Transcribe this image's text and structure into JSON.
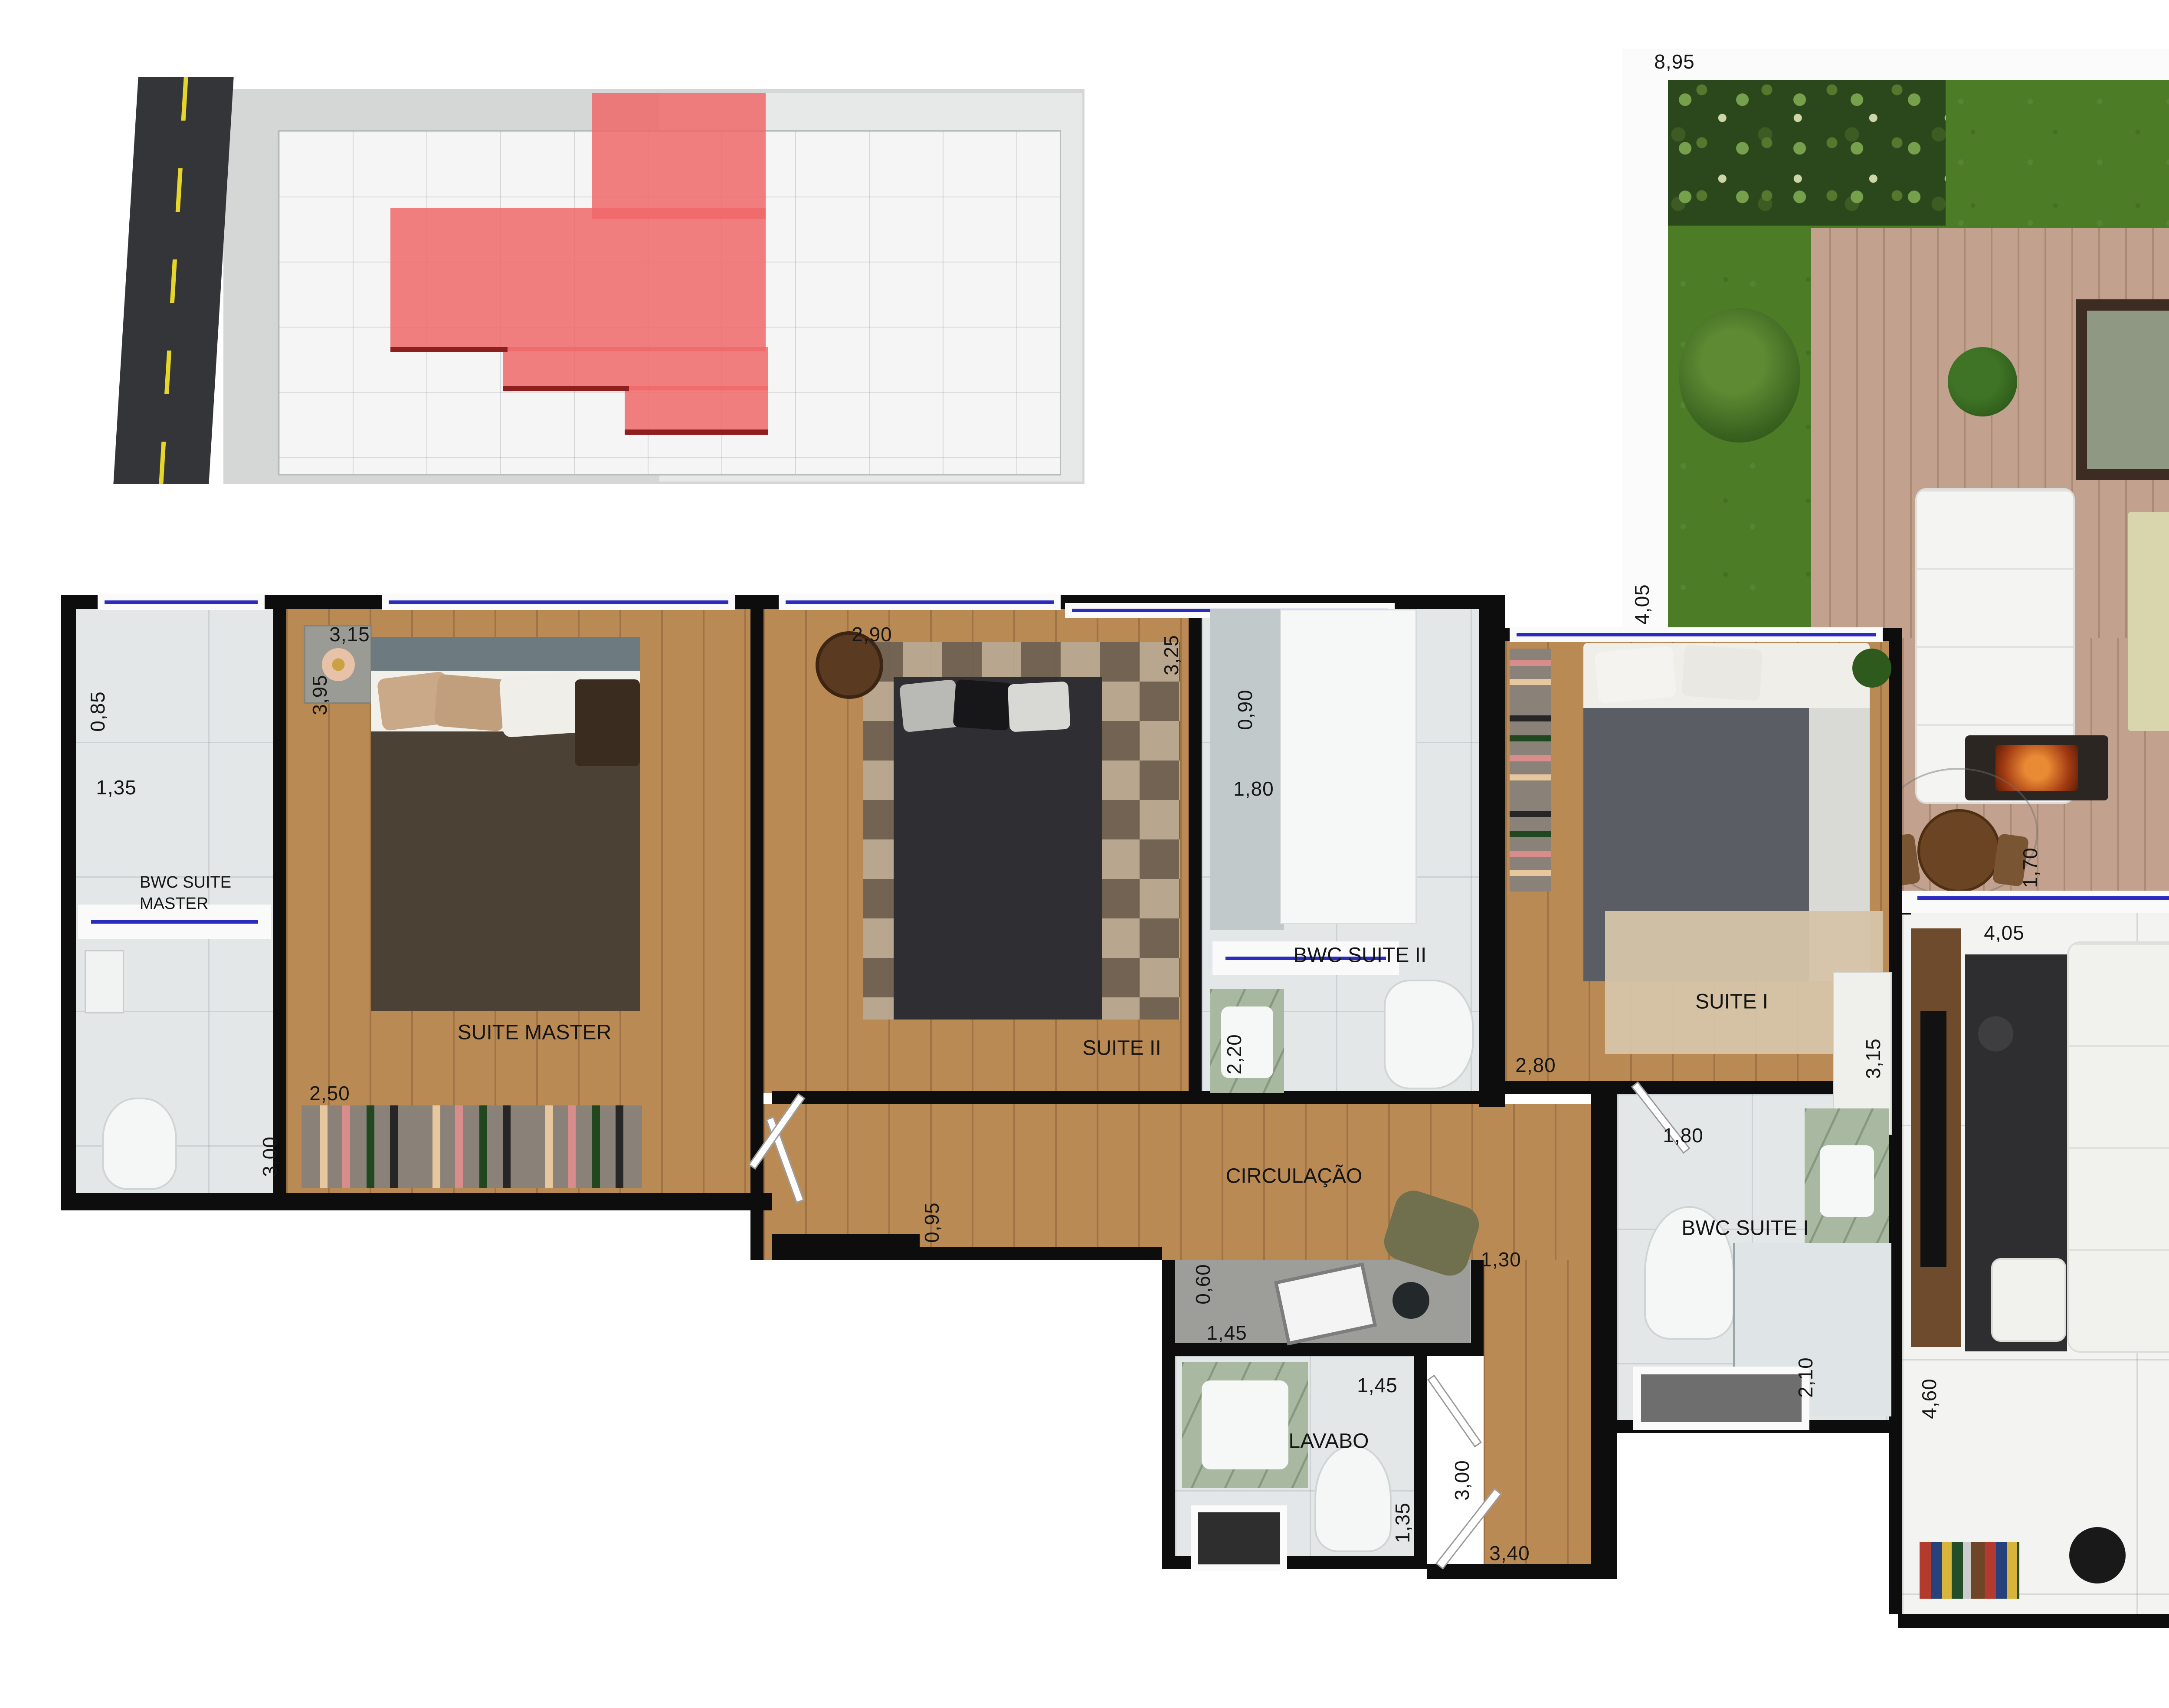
{
  "rooms": {
    "bwc_master": "BWC SUITE MASTER",
    "suite_master": "SUITE MASTER",
    "suite2": "SUITE II",
    "bwc2": "BWC SUITE II",
    "suite1": "SUITE I",
    "bwc1": "BWC SUITE I",
    "circulacao": "CIRCULAÇÃO",
    "lavabo": "LAVABO",
    "living": "LIVING",
    "cozinha": "COZINHA",
    "garden": "GARDEN",
    "servico": "A. SERVIÇO"
  },
  "dims": {
    "garden_width": "8,95",
    "garden_depth": "4,05",
    "terrace_right": "3,95",
    "bwc_master_shower_w": "0,85",
    "bwc_master_w": "1,35",
    "bwc_master_h": "3,00",
    "suite_master_w": "3,15",
    "suite_master_h": "3,95",
    "closet_master_w": "2,50",
    "suite2_w": "2,90",
    "suite2_h": "3,25",
    "bwc2_shower_w": "0,90",
    "bwc2_w": "1,80",
    "bwc2_h": "2,20",
    "suite1_w": "2,80",
    "suite1_h": "3,15",
    "circulacao_w": "0,95",
    "office_d": "0,60",
    "office_w": "1,45",
    "hall_w": "1,30",
    "lavabo_w": "1,45",
    "lavabo_h": "1,35",
    "hall_h": "3,00",
    "entry_w": "3,40",
    "bwc1_w": "1,80",
    "bwc1_h": "2,10",
    "deck_h": "1,70",
    "deck_counter_w": "4,30",
    "servico_h": "1,70",
    "servico_w": "1,45",
    "living_w": "4,05",
    "island_w": "2,60",
    "dining_h": "4,60",
    "living_h": "4,60"
  },
  "colors": {
    "wall": "#0d0d0d",
    "window_blue": "#2b2bbe",
    "highlight_red": "#ef6a6a",
    "grass_green": "#4d7c27",
    "wood_floor": "#ba8a55",
    "deck_wood": "#c2a28e",
    "marble_light": "#e4e7e8",
    "green_marble": "#a9b9a1",
    "road_asphalt": "#333538",
    "road_line_yellow": "#e6d52a"
  }
}
